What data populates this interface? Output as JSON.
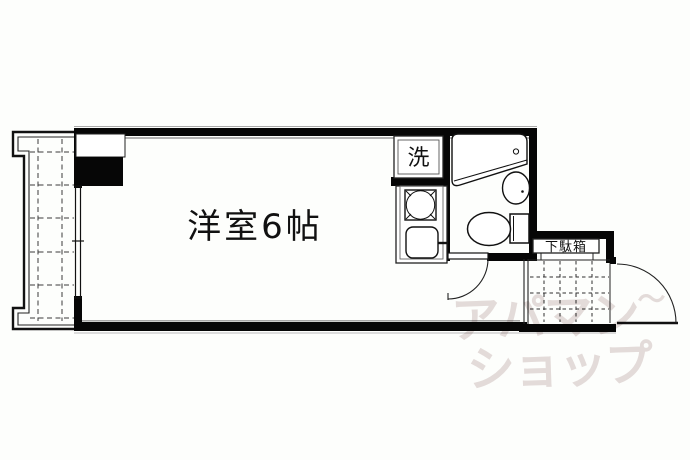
{
  "labels": {
    "room": "洋室6帖",
    "washer": "洗",
    "shoe_cabinet": "下駄箱"
  },
  "watermark": {
    "line1": "アパマン",
    "tilde": "〜",
    "line2": "ショップ",
    "color": "#e5dcdc"
  },
  "fixtures": {
    "balcony": "balcony-with-grid-floor",
    "window": "sliding-glass-window-to-balcony",
    "pillar": "pipe-space-pillar",
    "washer_space": "washing-machine-space",
    "stove": "single-burner-stove",
    "kitchen_sink": "kitchen-sink-with-faucet",
    "bathtub": "unit-bath-tub",
    "wash_basin": "wash-basin",
    "toilet": "toilet-with-tank",
    "bathroom_door": "swing-door-into-room",
    "genkan": "entrance-tiled-floor",
    "entrance_door": "outward-swing-entrance-door"
  },
  "colors": {
    "background": "#fdfefc",
    "wall": "#060606",
    "shade": "#999999",
    "grid_line": "#333333",
    "watermark": "#e5dcdc"
  }
}
